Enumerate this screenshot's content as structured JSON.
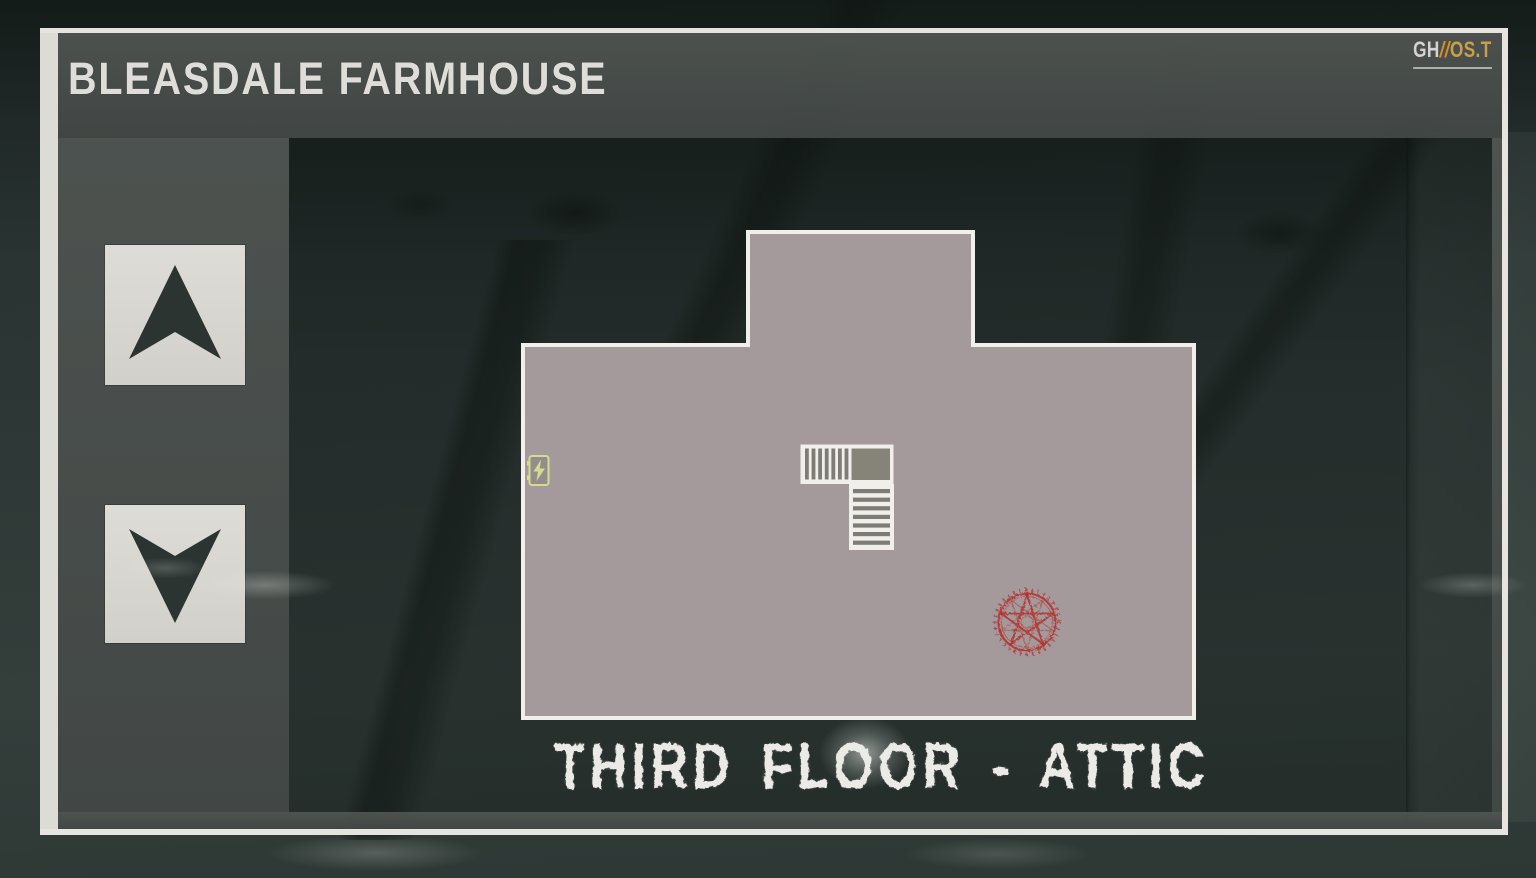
{
  "window": {
    "title": "BLEASDALE FARMHOUSE"
  },
  "brand": {
    "prefix": "GH",
    "slashes": "//",
    "suffix": "OS.T"
  },
  "sidebar": {
    "up_button_icon": "arrow-up-icon",
    "down_button_icon": "arrow-down-icon"
  },
  "map": {
    "floor_label": "THIRD FLOOR - ATTIC",
    "icons": [
      {
        "name": "fuse-box-icon",
        "glyph": "lightning-bolt"
      },
      {
        "name": "stairs-icon",
        "glyph": "l-shaped-staircase"
      },
      {
        "name": "summoning-circle-icon",
        "glyph": "red-pentagram"
      }
    ]
  },
  "colors": {
    "panel_gray": "#4a4f4c",
    "frame_white": "#e5e4e0",
    "map_fill": "#a49a9b",
    "map_outline": "#f1efec",
    "stair_tread": "#7e7c74",
    "stair_landing": "#868478",
    "fuse_green": "#d2dd90",
    "circle_red": "#b23430",
    "logo_orange": "#d98e2b",
    "logo_gold": "#c9a04a",
    "title_white": "#dfddd9",
    "arrow_dark": "#2c3431"
  }
}
